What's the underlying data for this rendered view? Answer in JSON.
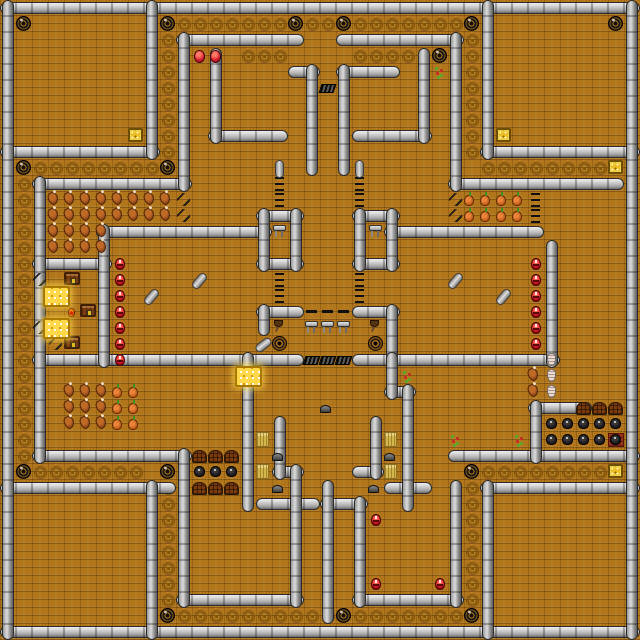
{
  "map": {
    "tile_px": 16,
    "cols": 40,
    "rows": 40,
    "colors": {
      "floor": "#b1761b",
      "floor_line": "#8a5a10",
      "wall_light": "#dcdcdc",
      "wall_dark": "#5f5f5f",
      "gold": "#ffd84a",
      "creature_red": "#c01020",
      "chest_wood": "#7a3c10"
    },
    "walls_h": [
      [
        0,
        0,
        40
      ],
      [
        0,
        39,
        40
      ],
      [
        0,
        9,
        10
      ],
      [
        30,
        9,
        10
      ],
      [
        0,
        30,
        11
      ],
      [
        30,
        30,
        10
      ],
      [
        11,
        2,
        8
      ],
      [
        21,
        2,
        8
      ],
      [
        13,
        8,
        5
      ],
      [
        22,
        8,
        5
      ],
      [
        18,
        4,
        2
      ],
      [
        21,
        4,
        4
      ],
      [
        2,
        11,
        10
      ],
      [
        28,
        11,
        11
      ],
      [
        6,
        14,
        11
      ],
      [
        24,
        14,
        10
      ],
      [
        2,
        16,
        5
      ],
      [
        16,
        13,
        3
      ],
      [
        16,
        16,
        3
      ],
      [
        22,
        13,
        3
      ],
      [
        22,
        16,
        3
      ],
      [
        16,
        19,
        3
      ],
      [
        22,
        19,
        3
      ],
      [
        2,
        22,
        17
      ],
      [
        22,
        22,
        13
      ],
      [
        24,
        24,
        2
      ],
      [
        33,
        25,
        4
      ],
      [
        2,
        28,
        10
      ],
      [
        28,
        28,
        12
      ],
      [
        17,
        29,
        2
      ],
      [
        22,
        29,
        2
      ],
      [
        24,
        30,
        3
      ],
      [
        16,
        31,
        4
      ],
      [
        20,
        31,
        3
      ],
      [
        11,
        37,
        8
      ],
      [
        22,
        37,
        7
      ]
    ],
    "walls_v": [
      [
        0,
        0,
        40
      ],
      [
        39,
        0,
        40
      ],
      [
        9,
        0,
        10
      ],
      [
        30,
        0,
        10
      ],
      [
        9,
        30,
        10
      ],
      [
        30,
        30,
        10
      ],
      [
        11,
        2,
        10
      ],
      [
        28,
        2,
        10
      ],
      [
        13,
        3,
        6
      ],
      [
        26,
        3,
        6
      ],
      [
        19,
        4,
        7
      ],
      [
        21,
        4,
        7
      ],
      [
        2,
        11,
        18
      ],
      [
        6,
        14,
        9
      ],
      [
        34,
        15,
        8
      ],
      [
        16,
        13,
        4
      ],
      [
        18,
        13,
        4
      ],
      [
        22,
        13,
        4
      ],
      [
        24,
        13,
        4
      ],
      [
        16,
        19,
        2
      ],
      [
        24,
        19,
        4
      ],
      [
        15,
        22,
        10
      ],
      [
        24,
        22,
        3
      ],
      [
        25,
        24,
        8
      ],
      [
        33,
        25,
        4
      ],
      [
        17,
        26,
        4
      ],
      [
        23,
        26,
        4
      ],
      [
        11,
        28,
        10
      ],
      [
        18,
        29,
        9
      ],
      [
        20,
        30,
        9
      ],
      [
        22,
        31,
        7
      ],
      [
        28,
        30,
        8
      ]
    ],
    "swirl_runs": [
      [
        11,
        1,
        1,
        0,
        7
      ],
      [
        19,
        1,
        1,
        0,
        2
      ],
      [
        22,
        1,
        1,
        0,
        7
      ],
      [
        15,
        3,
        1,
        0,
        3
      ],
      [
        22,
        3,
        1,
        0,
        4
      ],
      [
        2,
        10,
        1,
        0,
        8
      ],
      [
        30,
        10,
        1,
        0,
        8
      ],
      [
        1,
        11,
        0,
        1,
        18
      ],
      [
        10,
        2,
        0,
        1,
        8
      ],
      [
        29,
        2,
        0,
        1,
        8
      ],
      [
        10,
        30,
        0,
        1,
        8
      ],
      [
        29,
        30,
        0,
        1,
        8
      ],
      [
        2,
        29,
        1,
        0,
        7
      ],
      [
        30,
        29,
        1,
        0,
        8
      ],
      [
        11,
        38,
        1,
        0,
        10
      ],
      [
        22,
        38,
        1,
        0,
        7
      ]
    ],
    "item_runs": {
      "meat": [
        [
          3,
          12,
          1,
          0,
          4
        ],
        [
          3,
          13,
          1,
          0,
          4
        ],
        [
          3,
          14,
          1,
          0,
          4
        ],
        [
          3,
          15,
          1,
          0,
          4
        ],
        [
          7,
          12,
          1,
          0,
          4
        ],
        [
          7,
          13,
          1,
          0,
          4
        ],
        [
          4,
          24,
          1,
          0,
          3
        ],
        [
          4,
          25,
          1,
          0,
          3
        ],
        [
          4,
          26,
          1,
          0,
          3
        ],
        [
          33,
          23,
          0,
          1,
          2
        ]
      ],
      "veg": [
        [
          29,
          12,
          1,
          0,
          4
        ],
        [
          29,
          13,
          1,
          0,
          4
        ],
        [
          7,
          24,
          0,
          1,
          3
        ],
        [
          8,
          24,
          0,
          1,
          3
        ]
      ],
      "red_bug": [
        [
          7,
          16,
          0,
          1,
          7
        ],
        [
          33,
          16,
          0,
          1,
          6
        ]
      ],
      "bird": [
        [
          12,
          29,
          1,
          0,
          3
        ],
        [
          34,
          26,
          1,
          0,
          5
        ],
        [
          34,
          27,
          1,
          0,
          5
        ]
      ]
    },
    "items": {
      "hole": [
        [
          1,
          1
        ],
        [
          10,
          1
        ],
        [
          18,
          1
        ],
        [
          21,
          1
        ],
        [
          29,
          1
        ],
        [
          38,
          1
        ],
        [
          27,
          3
        ],
        [
          1,
          10
        ],
        [
          10,
          10
        ],
        [
          1,
          29
        ],
        [
          10,
          29
        ],
        [
          29,
          29
        ],
        [
          10,
          38
        ],
        [
          21,
          38
        ],
        [
          29,
          38
        ]
      ],
      "gold_chest": [
        [
          8,
          8
        ],
        [
          31,
          8
        ],
        [
          38,
          10
        ],
        [
          38,
          29
        ]
      ],
      "gold_door": [
        [
          3,
          18
        ],
        [
          3,
          20
        ],
        [
          15,
          23
        ]
      ],
      "wood_chest": [
        [
          4,
          17
        ],
        [
          5,
          19
        ],
        [
          4,
          21
        ]
      ],
      "red_bug": [
        [
          23,
          32
        ],
        [
          23,
          36
        ],
        [
          27,
          36
        ]
      ],
      "red_egg": [
        [
          12,
          3
        ],
        [
          13,
          3
        ]
      ],
      "chair": [
        [
          17,
          14
        ],
        [
          23,
          14
        ],
        [
          19,
          20
        ],
        [
          20,
          20
        ],
        [
          21,
          20
        ]
      ],
      "grate": [
        [
          20,
          5
        ],
        [
          19,
          22
        ],
        [
          20,
          22
        ],
        [
          21,
          22
        ]
      ],
      "pit": [
        [
          17,
          21
        ],
        [
          23,
          21
        ]
      ],
      "axe": [
        [
          17,
          20
        ],
        [
          23,
          20
        ]
      ],
      "rock": [
        [
          20,
          25
        ],
        [
          17,
          28
        ],
        [
          24,
          28
        ],
        [
          17,
          30
        ],
        [
          23,
          30
        ]
      ],
      "hay": [
        [
          16,
          27
        ],
        [
          16,
          29
        ],
        [
          24,
          27
        ],
        [
          24,
          29
        ]
      ],
      "arch": [
        [
          12,
          28
        ],
        [
          13,
          28
        ],
        [
          14,
          28
        ],
        [
          12,
          30
        ],
        [
          13,
          30
        ],
        [
          14,
          30
        ],
        [
          36,
          25
        ],
        [
          37,
          25
        ],
        [
          38,
          25
        ]
      ],
      "mat": [
        [
          38,
          27
        ]
      ],
      "plant": [
        [
          27,
          4
        ],
        [
          25,
          23
        ],
        [
          28,
          27
        ],
        [
          32,
          27
        ]
      ],
      "vase": [
        [
          34,
          22
        ],
        [
          34,
          23
        ],
        [
          34,
          24
        ]
      ],
      "stair": [
        [
          2,
          17
        ],
        [
          3,
          18
        ],
        [
          2,
          20
        ],
        [
          3,
          21
        ],
        [
          11,
          12
        ],
        [
          11,
          13
        ],
        [
          28,
          12
        ],
        [
          28,
          13
        ]
      ],
      "dashv": [
        [
          17,
          11
        ],
        [
          17,
          12
        ],
        [
          22,
          11
        ],
        [
          22,
          12
        ],
        [
          17,
          17
        ],
        [
          17,
          18
        ],
        [
          22,
          17
        ],
        [
          22,
          18
        ],
        [
          33,
          12
        ],
        [
          33,
          13
        ]
      ],
      "dashh": [
        [
          19,
          19
        ],
        [
          20,
          19
        ],
        [
          21,
          19
        ]
      ],
      "ember": [
        [
          4,
          19
        ]
      ]
    },
    "capsules": [
      {
        "x": 17,
        "y": 10,
        "rot": 0
      },
      {
        "x": 22,
        "y": 10,
        "rot": 0
      },
      {
        "x": 12,
        "y": 17,
        "rot": 40
      },
      {
        "x": 9,
        "y": 18,
        "rot": 40
      },
      {
        "x": 28,
        "y": 17,
        "rot": 40
      },
      {
        "x": 31,
        "y": 18,
        "rot": 40
      },
      {
        "x": 16,
        "y": 21,
        "rot": 52
      }
    ],
    "interactable_types": [
      "gold_chest",
      "gold_door",
      "wood_chest",
      "red_bug",
      "bird",
      "chair",
      "red_egg",
      "arch"
    ]
  }
}
